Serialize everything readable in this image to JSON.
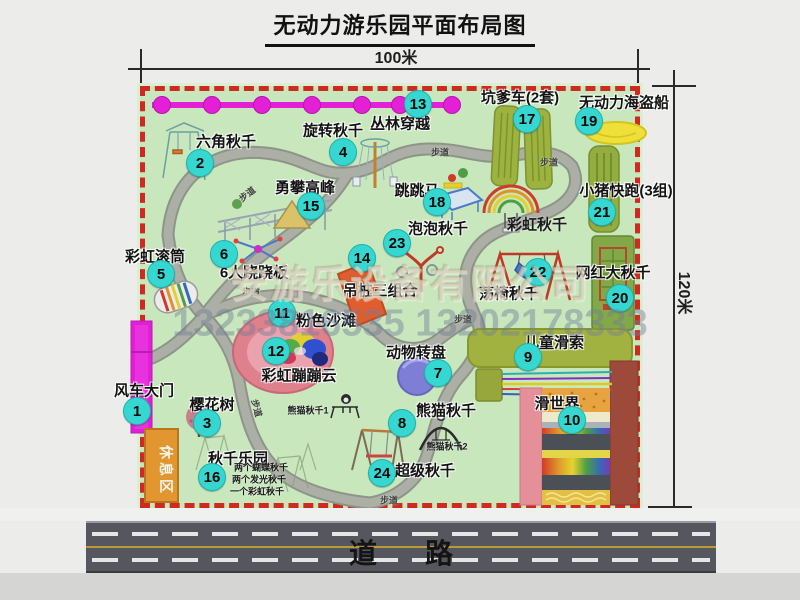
{
  "title": "无动力游乐园平面布局图",
  "dimensions": {
    "top": "100米",
    "right": "120米"
  },
  "watermark": {
    "company": "安游乐设备有限公司",
    "phone": "13233816535 13202178333"
  },
  "road_label": "道路",
  "rest_area": "休息区",
  "path_label": "步道",
  "path_label_positions": [
    {
      "x": 247,
      "y": 194,
      "rot": -38
    },
    {
      "x": 440,
      "y": 152,
      "rot": 0
    },
    {
      "x": 549,
      "y": 162,
      "rot": 0
    },
    {
      "x": 251,
      "y": 292,
      "rot": 0
    },
    {
      "x": 463,
      "y": 319,
      "rot": 0
    },
    {
      "x": 257,
      "y": 408,
      "rot": 75
    },
    {
      "x": 389,
      "y": 500,
      "rot": 0
    }
  ],
  "attractions": [
    {
      "num": "1",
      "name": "风车大门",
      "bx": 137,
      "by": 411,
      "lx": 144,
      "ly": 390
    },
    {
      "num": "2",
      "name": "六角秋千",
      "bx": 200,
      "by": 163,
      "lx": 226,
      "ly": 141
    },
    {
      "num": "3",
      "name": "樱花树",
      "bx": 207,
      "by": 423,
      "lx": 212,
      "ly": 404
    },
    {
      "num": "4",
      "name": "旋转秋千",
      "bx": 343,
      "by": 152,
      "lx": 333,
      "ly": 130
    },
    {
      "num": "5",
      "name": "彩虹滚筒",
      "bx": 161,
      "by": 274,
      "lx": 155,
      "ly": 256
    },
    {
      "num": "6",
      "name": "6人跷跷板",
      "bx": 224,
      "by": 254,
      "lx": 254,
      "ly": 272
    },
    {
      "num": "7",
      "name": "动物转盘",
      "bx": 438,
      "by": 373,
      "lx": 416,
      "ly": 352
    },
    {
      "num": "8",
      "name": "熊猫秋千",
      "bx": 402,
      "by": 423,
      "lx": 446,
      "ly": 410
    },
    {
      "num": "9",
      "name": "儿童滑索",
      "bx": 528,
      "by": 357,
      "lx": 554,
      "ly": 342
    },
    {
      "num": "10",
      "name": "滑世界",
      "bx": 572,
      "by": 420,
      "lx": 557,
      "ly": 403
    },
    {
      "num": "11",
      "name": "粉色沙滩",
      "bx": 282,
      "by": 313,
      "lx": 326,
      "ly": 320
    },
    {
      "num": "12",
      "name": "彩虹蹦蹦云",
      "bx": 276,
      "by": 351,
      "lx": 299,
      "ly": 375
    },
    {
      "num": "13",
      "name": "丛林穿越",
      "bx": 418,
      "by": 104,
      "lx": 400,
      "ly": 123
    },
    {
      "num": "14",
      "name": "吊桩三组合",
      "bx": 362,
      "by": 258,
      "lx": 380,
      "ly": 290
    },
    {
      "num": "15",
      "name": "勇攀高峰",
      "bx": 311,
      "by": 206,
      "lx": 305,
      "ly": 187
    },
    {
      "num": "16",
      "name": "秋千乐园",
      "bx": 212,
      "by": 477,
      "lx": 238,
      "ly": 458
    },
    {
      "num": "17",
      "name": "坑爹车(2套)",
      "bx": 527,
      "by": 119,
      "lx": 520,
      "ly": 97
    },
    {
      "num": "18",
      "name": "跳跳马",
      "bx": 437,
      "by": 202,
      "lx": 417,
      "ly": 190
    },
    {
      "num": "19",
      "name": "无动力海盗船",
      "bx": 589,
      "by": 121,
      "lx": 624,
      "ly": 102
    },
    {
      "num": "20",
      "name": "网红大秋千",
      "bx": 620,
      "by": 298,
      "lx": 613,
      "ly": 272
    },
    {
      "num": "21",
      "name": "小猪快跑(3组)",
      "bx": 602,
      "by": 212,
      "lx": 626,
      "ly": 190
    },
    {
      "num": "22",
      "name": "荡椅秋千",
      "bx": 538,
      "by": 272,
      "lx": 509,
      "ly": 293
    },
    {
      "num": "23",
      "name": "泡泡秋千",
      "bx": 397,
      "by": 243,
      "lx": 438,
      "ly": 228
    },
    {
      "num": "24",
      "name": "超级秋千",
      "bx": 382,
      "by": 473,
      "lx": 425,
      "ly": 470
    }
  ],
  "sub_labels": [
    {
      "text": "彩虹秋千",
      "x": 537,
      "y": 224,
      "size": 15
    },
    {
      "text": "熊猫秋千1",
      "x": 308,
      "y": 410,
      "size": 9
    },
    {
      "text": "熊猫秋千2",
      "x": 447,
      "y": 446,
      "size": 9
    },
    {
      "text": "两个蝴蝶秋千",
      "x": 261,
      "y": 467,
      "size": 9
    },
    {
      "text": "两个发光秋千",
      "x": 259,
      "y": 479,
      "size": 9
    },
    {
      "text": "一个彩虹秋千",
      "x": 257,
      "y": 491,
      "size": 9
    }
  ],
  "colors": {
    "park_green": "#c8e7bd",
    "border_red": "#cf2a20",
    "path_gray": "#a5a8a0",
    "badge_cyan": "#35d7d0",
    "gate_magenta": "#e01fd7",
    "jungle_magenta": "#e320d6",
    "rest_orange": "#e2962f",
    "road_gray": "#56565e",
    "road_yellow": "#b9993a",
    "pirate_yellow": "#efdf3a",
    "beach_pink": "#df808d",
    "turntable_purple": "#7e7ed6",
    "cart_olive": "#9db23f",
    "maroon_band": "#9e4a3a"
  }
}
